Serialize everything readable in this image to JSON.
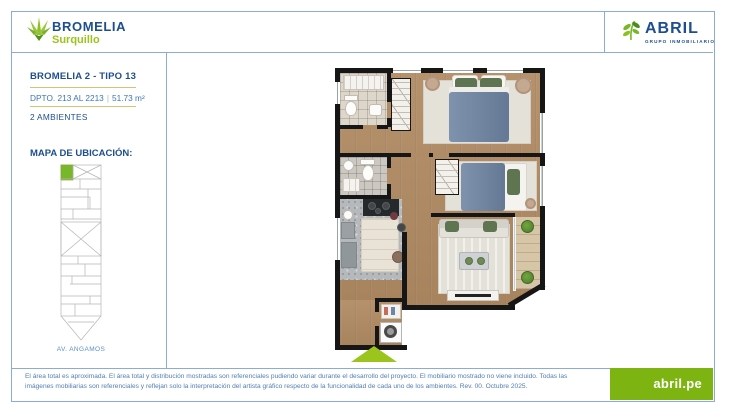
{
  "header": {
    "bromelia": {
      "name": "BROMELIA",
      "district": "Surquillo"
    },
    "abril": {
      "name": "ABRIL",
      "tagline": "GRUPO INMOBILIARIO"
    }
  },
  "info_panel": {
    "unit_title": "BROMELIA 2 - TIPO 13",
    "unit_range": "DPTO. 213 AL 2213",
    "separator": "|",
    "unit_area": "51.73 m²",
    "rooms_label": "2 AMBIENTES",
    "map_title": "MAPA DE UBICACIÓN:",
    "street": "AV. ANGAMOS"
  },
  "footer": {
    "disclaimer": "El área total es aproximada. El área total y distribución mostradas son referenciales pudiendo variar durante el desarrollo del proyecto. El mobiliario mostrado no viene incluido. Todas las imágenes mobiliarias son referenciales y reflejan solo la interpretación del artista gráfico respecto de la funcionalidad de cada uno de los ambientes. Rev. 00. Octubre 2025.",
    "website": "abril.pe"
  },
  "colors": {
    "navy": "#1d4e8e",
    "green": "#76b82a",
    "light_green": "#9bc41d",
    "frame_blue": "#8badd1",
    "gold_divider": "#d2c377",
    "footer_text": "#507eb4",
    "footer_green": "#7db412",
    "map_highlight": "#76b82a",
    "plan_wall": "#161616",
    "plan_wood": "#b08c66",
    "plan_bed": "#6d83a2",
    "plan_pillow_green": "#5f7552"
  }
}
